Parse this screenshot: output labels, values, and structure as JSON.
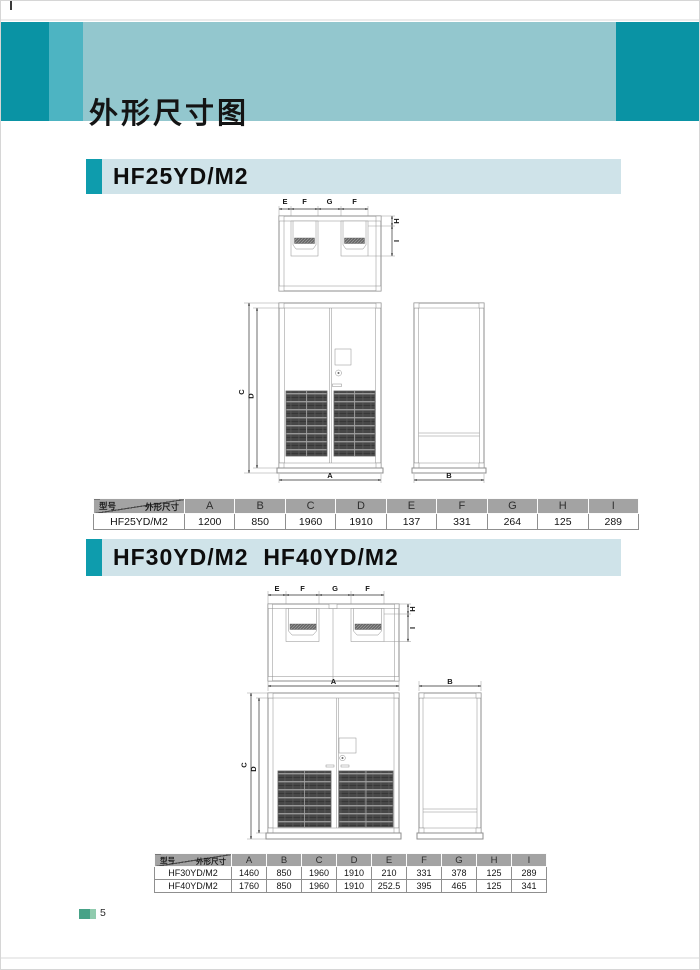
{
  "page": {
    "title": "外形尺寸图",
    "page_number": "5"
  },
  "corner": {
    "model_label": "型号",
    "dims_label": "外形尺寸"
  },
  "dim_labels": {
    "A": "A",
    "B": "B",
    "C": "C",
    "D": "D",
    "E": "E",
    "F": "F",
    "G": "G",
    "H": "H",
    "I": "I"
  },
  "section1": {
    "heading": "HF25YD/M2",
    "table": {
      "columns": [
        "A",
        "B",
        "C",
        "D",
        "E",
        "F",
        "G",
        "H",
        "I"
      ],
      "rows": [
        {
          "model": "HF25YD/M2",
          "values": [
            "1200",
            "850",
            "1960",
            "1910",
            "137",
            "331",
            "264",
            "125",
            "289"
          ]
        }
      ]
    }
  },
  "section2": {
    "heading": "HF30YD/M2  HF40YD/M2",
    "table": {
      "columns": [
        "A",
        "B",
        "C",
        "D",
        "E",
        "F",
        "G",
        "H",
        "I"
      ],
      "rows": [
        {
          "model": "HF30YD/M2",
          "values": [
            "1460",
            "850",
            "1960",
            "1910",
            "210",
            "331",
            "378",
            "125",
            "289"
          ]
        },
        {
          "model": "HF40YD/M2",
          "values": [
            "1760",
            "850",
            "1960",
            "1910",
            "252.5",
            "395",
            "465",
            "125",
            "341"
          ]
        }
      ]
    }
  }
}
